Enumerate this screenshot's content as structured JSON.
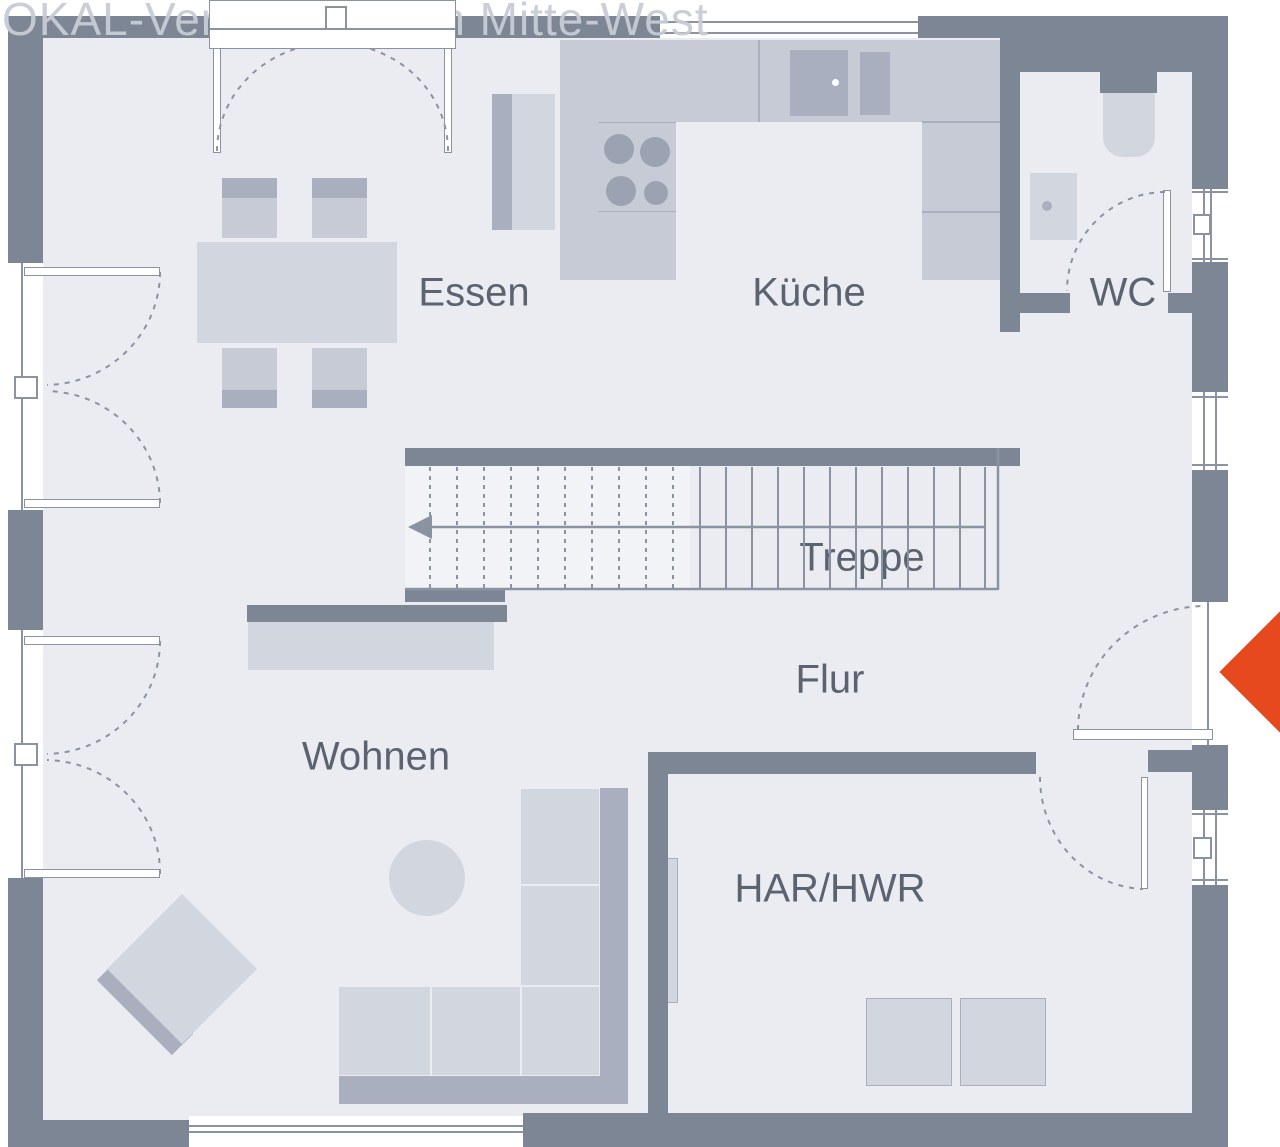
{
  "watermark": {
    "text": "OKAL-Verkaufsregion Mitte-West"
  },
  "rooms": {
    "essen": {
      "label": "Essen"
    },
    "kueche": {
      "label": "Küche"
    },
    "wc": {
      "label": "WC"
    },
    "treppe": {
      "label": "Treppe"
    },
    "flur": {
      "label": "Flur"
    },
    "wohnen": {
      "label": "Wohnen"
    },
    "har_hwr": {
      "label": "HAR/HWR"
    }
  },
  "colors": {
    "wall": "#7d8695",
    "floor": "#eaecf1",
    "floorlight": "#f1f3f7",
    "furn": "#d2d6de",
    "furnmid": "#c7cbd5",
    "accent": "#a9afbe",
    "accent2": "#9ba3b3",
    "line": "#8b93a3",
    "label": "#5c6370",
    "watermark": "#c7ccd5",
    "red": "#e5491d"
  }
}
